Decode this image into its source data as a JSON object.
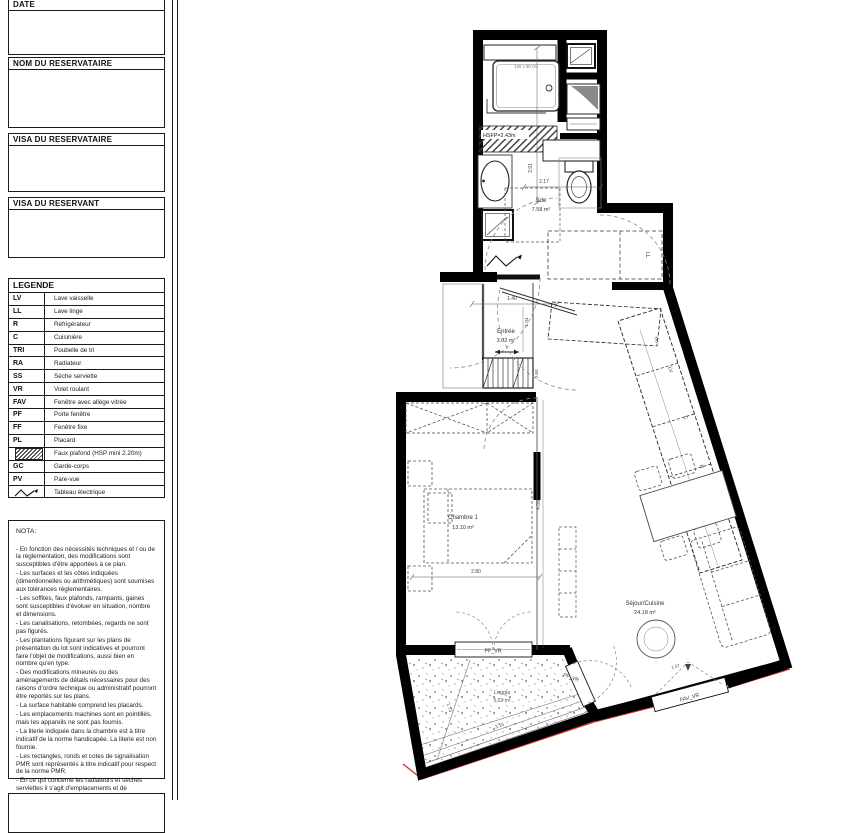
{
  "sidebar": {
    "boxes": [
      {
        "label": "DATE"
      },
      {
        "label": "NOM DU RESERVATAIRE"
      },
      {
        "label": "VISA DU RESERVATAIRE"
      },
      {
        "label": "VISA DU RESERVANT"
      }
    ],
    "legend": {
      "title": "LEGENDE",
      "rows": [
        {
          "abbr": "LV",
          "label": "Lave vaisselle"
        },
        {
          "abbr": "LL",
          "label": "Lave linge"
        },
        {
          "abbr": "R",
          "label": "Réfrigérateur"
        },
        {
          "abbr": "C",
          "label": "Cuisinière"
        },
        {
          "abbr": "TRI",
          "label": "Poubelle de tri"
        },
        {
          "abbr": "RA",
          "label": "Radiateur"
        },
        {
          "abbr": "SS",
          "label": "Sèche serviette"
        },
        {
          "abbr": "VR",
          "label": "Volet roulant"
        },
        {
          "abbr": "FAV",
          "label": "Fenêtre avec allège vitrée"
        },
        {
          "abbr": "PF",
          "label": "Porte fenêtre"
        },
        {
          "abbr": "FF",
          "label": "Fenêtre fixe"
        },
        {
          "abbr": "PL",
          "label": "Placard"
        },
        {
          "abbr": "",
          "label": "Faux plafond (HSP mini 2.20m)"
        },
        {
          "abbr": "GC",
          "label": "Garde-corps"
        },
        {
          "abbr": "PV",
          "label": "Pare-vue"
        },
        {
          "abbr": "",
          "label": "Tableau électrique"
        }
      ]
    },
    "nota": {
      "title": "NOTA:",
      "lines": [
        "- En fonction des nécessités techniques et / ou de la réglementation, des modifications sont susceptibles d'être apportées à ce plan.",
        "- Les surfaces et les côtes indiquées (dimentionnelles ou arithmétiques) sont soumises aux tolérances réglementaires.",
        "- Les soffites, faux plafonds, rampants, gaines sont susceptibles d'évoluer en situation, nombre et dimensions.",
        "- Les canalisations, retombées, regards ne sont pas figurés.",
        "- Les plantations figurant sur les plans de présentation du lot sont indicatives et pourront faire l'objet de modifications, aussi bien en nombre qu'en type.",
        "- Des modifications mineures ou des aménagements de détails nécessaires pour des raisons d'ordre technique ou administratif pourront être reportés sur les plans.",
        "- La surface habitable comprend les placards.",
        "- Les emplacements machines sont en pointillés, mais les appareils ne sont pas fournis.",
        "- La literie indiquée dans la chambre est à titre indicatif de la norme handicapée. La literie est non fournie.",
        "- Les rectangles, ronds et cotes de signalisation PMR sont représentés à titre indicatif pour respect de la norme PMR.",
        "- En ce qui concerne les radiateurs et sèches serviettes il s'agit d'emplacements et de dimensions de principe."
      ]
    }
  },
  "plan": {
    "rooms": {
      "sde": {
        "name": "Sde",
        "area": "7.58 m²"
      },
      "entree": {
        "name": "Entrée",
        "area": "3.02 m²"
      },
      "chambre": {
        "name": "Chambre 1",
        "area": "13.10 m²"
      },
      "sejour": {
        "name": "Séjour/Cuisine",
        "area": "24.18 m²"
      },
      "loggia": {
        "name": "Loggia",
        "area": "5.02 m²"
      }
    },
    "labels": {
      "hsfp": "HSFP=2.43m",
      "shower": "120 x 90 cm"
    },
    "appliances": {
      "ll": "LL",
      "lv": "LV",
      "c": "C",
      "r": "R",
      "tri": "TRI"
    },
    "windows": {
      "pf1": "PF_VR",
      "pf2": "PF_VR",
      "fav": "FAV_VR"
    },
    "dims": {
      "d391": "3.91",
      "d217": "2.17",
      "d140": "1.40",
      "d104": "1.04",
      "d060": "0.60",
      "d280": "2.80",
      "d409": "4.09",
      "d157": "1.57",
      "d315": "3.15",
      "d173": "1.73"
    },
    "colors": {
      "wall": "#000000",
      "red": "#d9342b",
      "gray": "#8a8a8a"
    }
  }
}
